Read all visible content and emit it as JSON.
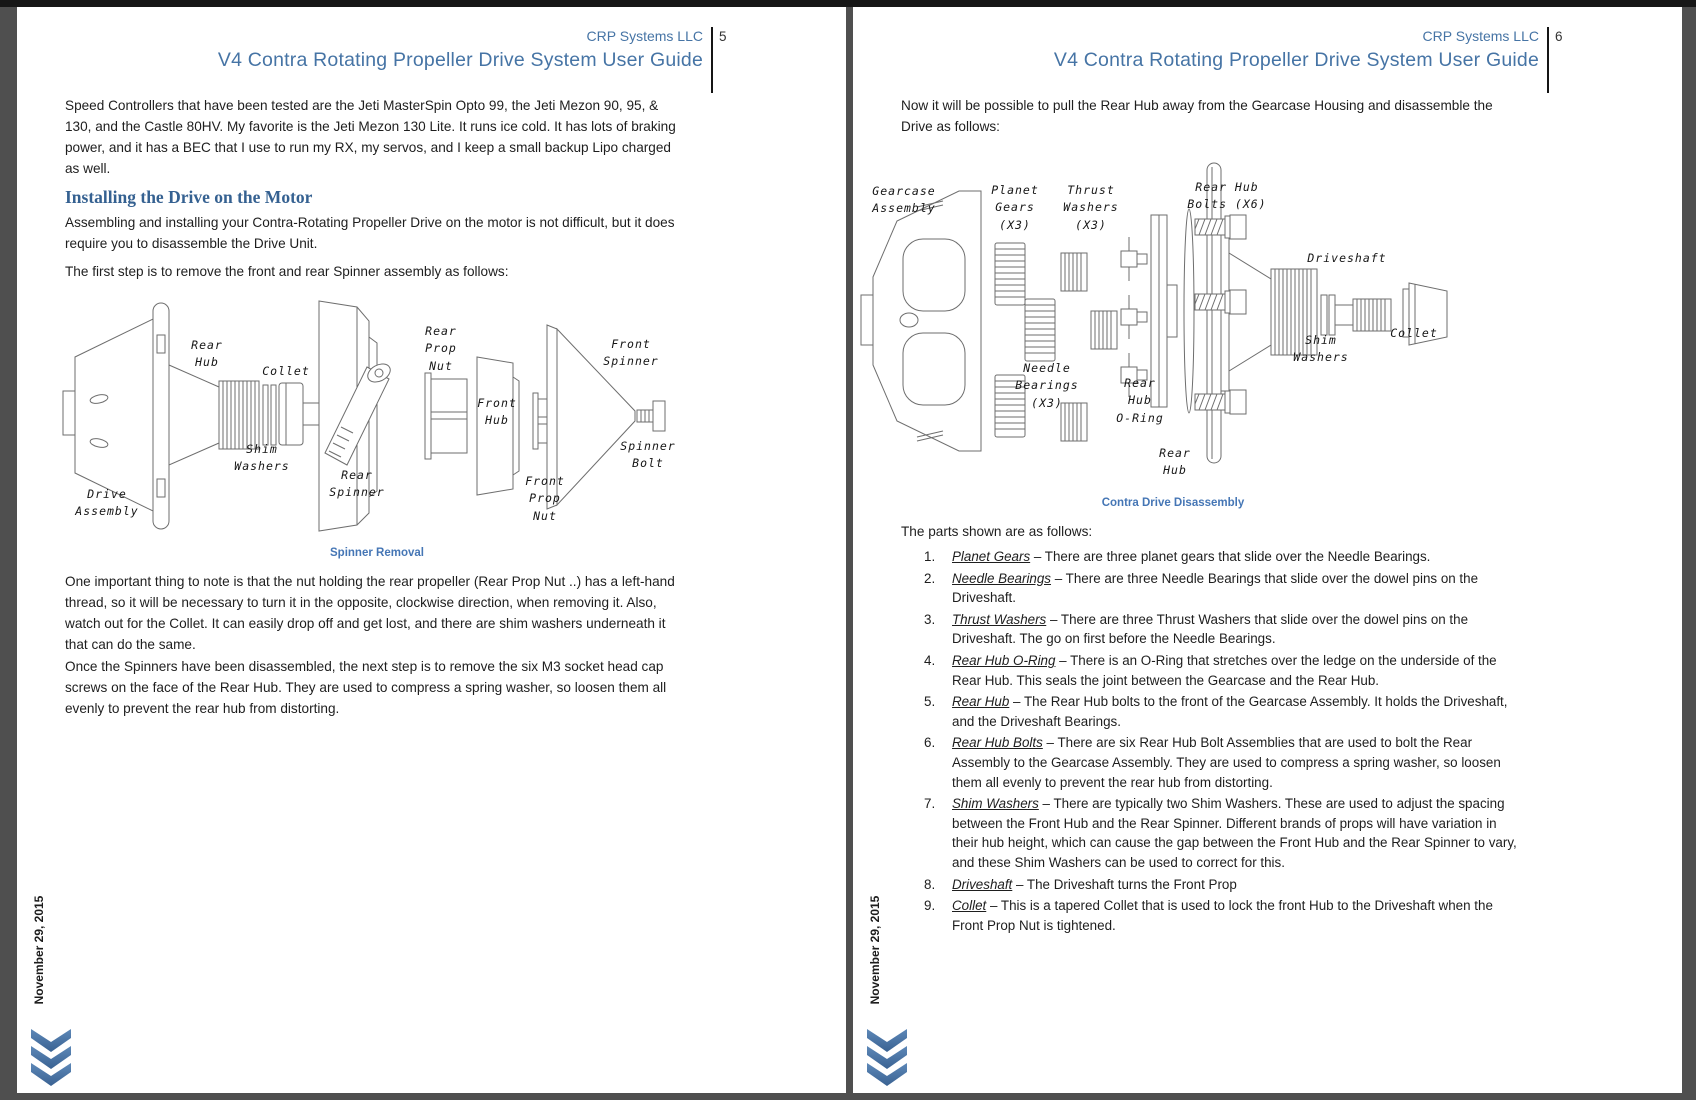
{
  "doc": {
    "sidebar_date": "November 29, 2015",
    "colors": {
      "title_blue": "#4674a5",
      "heading_blue": "#356191",
      "caption_blue": "#4576b5",
      "chevron_blue": "#4a74a8",
      "frame_gray": "#4f4f4f"
    },
    "pages": [
      {
        "header": {
          "company": "CRP Systems LLC",
          "page_number": "5"
        },
        "title": "V4 Contra Rotating Propeller Drive System User Guide",
        "body": {
          "para1": "Speed Controllers that have been tested are the Jeti MasterSpin Opto 99, the Jeti Mezon 90, 95, & 130, and the Castle 80HV. My favorite is the Jeti Mezon 130 Lite. It runs ice cold. It has lots of braking power, and it has a BEC that I use to run my RX, my servos, and I keep a small backup Lipo charged as well.",
          "section_heading": "Installing the Drive on the Motor",
          "para2": "Assembling and installing your Contra-Rotating Propeller Drive on the motor is not difficult, but it does require you to disassemble the Drive Unit.",
          "para3": "The first step is to remove the front and rear Spinner assembly as follows:",
          "para4": "One important thing to note is that the nut holding the rear propeller (Rear Prop Nut ..) has a left-hand thread, so it will be necessary to turn it in the opposite, clockwise direction, when removing it. Also, watch out for the Collet. It can easily drop off and get lost, and there are shim washers underneath it that can do the same.",
          "para5": "Once the Spinners have been disassembled, the next step is to remove the six M3 socket head cap screws on the face of the Rear Hub. They are used to compress a spring washer, so loosen them all evenly to prevent the rear hub from distorting."
        },
        "figure": {
          "caption": "Spinner Removal",
          "labels": [
            "Rear\nHub",
            "Collet",
            "Shim\nWashers",
            "Rear\nSpinner",
            "Rear\nProp\nNut",
            "Front\nHub",
            "Front\nProp\nNut",
            "Front\nSpinner",
            "Spinner\nBolt",
            "Drive\nAssembly"
          ]
        }
      },
      {
        "header": {
          "company": "CRP Systems LLC",
          "page_number": "6"
        },
        "title": "V4 Contra Rotating Propeller Drive System User Guide",
        "body": {
          "para1": "Now it will be possible to pull the Rear Hub away from the Gearcase Housing and disassemble the Drive as follows:",
          "list_intro": "The parts shown are as follows:"
        },
        "figure": {
          "caption": "Contra Drive Disassembly",
          "labels": [
            "Gearcase\nAssembly",
            "Planet\nGears\n(X3)",
            "Thrust\nWashers\n(X3)",
            "Rear Hub\nBolts (X6)",
            "Driveshaft",
            "Needle\nBearings\n(X3)",
            "Rear\nHub\nO-Ring",
            "Rear\nHub",
            "Shim\nWashers",
            "Collet"
          ]
        },
        "parts_list": [
          {
            "num": "1.",
            "term": "Planet Gears",
            "desc": " – There are three planet gears that slide over the Needle Bearings."
          },
          {
            "num": "2.",
            "term": "Needle Bearings",
            "desc": " – There are three Needle Bearings that slide over the dowel pins on the Driveshaft."
          },
          {
            "num": "3.",
            "term": "Thrust Washers",
            "desc": " – There are three Thrust Washers that slide over the dowel pins on the Driveshaft. The go on first before the Needle Bearings."
          },
          {
            "num": "4.",
            "term": "Rear Hub O-Ring",
            "desc": " – There is an O-Ring that stretches over the ledge on the underside of the Rear Hub. This seals the joint between the Gearcase and the Rear Hub."
          },
          {
            "num": "5.",
            "term": "Rear Hub",
            "desc": " – The Rear Hub bolts to the front of the Gearcase Assembly. It holds the Driveshaft, and the Driveshaft Bearings."
          },
          {
            "num": "6.",
            "term": "Rear Hub Bolts",
            "desc": " – There are six Rear Hub Bolt Assemblies that are used to bolt the Rear Assembly to the Gearcase Assembly. They are used to compress a spring washer, so loosen them all evenly to prevent the rear hub from distorting."
          },
          {
            "num": "7.",
            "term": "Shim Washers",
            "desc": " – There are typically two Shim Washers. These are used to adjust the spacing between the Front Hub and the Rear Spinner. Different brands of props will have variation in their hub height, which can cause the gap between the Front Hub and the Rear Spinner to vary, and these Shim Washers can be used to correct for this."
          },
          {
            "num": "8.",
            "term": "Driveshaft",
            "desc": " – The Driveshaft turns the Front Prop"
          },
          {
            "num": "9.",
            "term": "Collet",
            "desc": " – This is a tapered Collet that is used to lock the front Hub to the Driveshaft when the Front Prop Nut is tightened."
          }
        ]
      }
    ]
  }
}
